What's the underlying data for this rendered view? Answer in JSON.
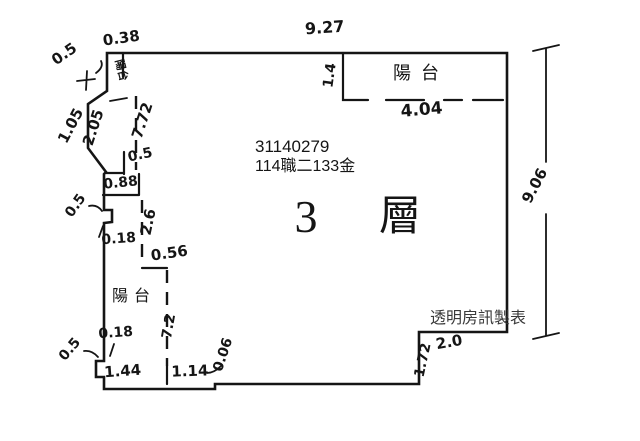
{
  "colors": {
    "ink": "#151515",
    "background": "#ffffff",
    "watermark": "#3a3a3a"
  },
  "labels": {
    "id_number": "31140279",
    "zone": "114職二133金",
    "floor_number": "3",
    "floor_unit": "層",
    "watermark": "透明房訊製表",
    "balcony_top_left": "陽台",
    "balcony_top_right": "陽台",
    "balcony_bottom_left": "陽台"
  },
  "dimensions": {
    "top_left_width": "0.38",
    "top_width": "9.27",
    "top_left_offset": "0.5",
    "balcony_right_depth": "1.4",
    "balcony_right_width": "4.04",
    "left_slant_outer": "1.05",
    "left_slant_inner": "2.05",
    "left_upper_height": "7.72",
    "upper_stub": "0.5",
    "box_width": "0.88",
    "left_mid_notch": "0.5",
    "mid_height": "2.6",
    "mid_offset_upper": "0.18",
    "step_width": "0.56",
    "mid_offset_lower": "0.18",
    "lower_height": "7.2",
    "bottom_left_notch": "0.5",
    "bottom_width_left": "1.44",
    "bottom_width_mid": "1.14",
    "bottom_step": "0.06",
    "bottom_right_height": "1.72",
    "bottom_right_width": "2.0",
    "right_height": "9.06"
  }
}
